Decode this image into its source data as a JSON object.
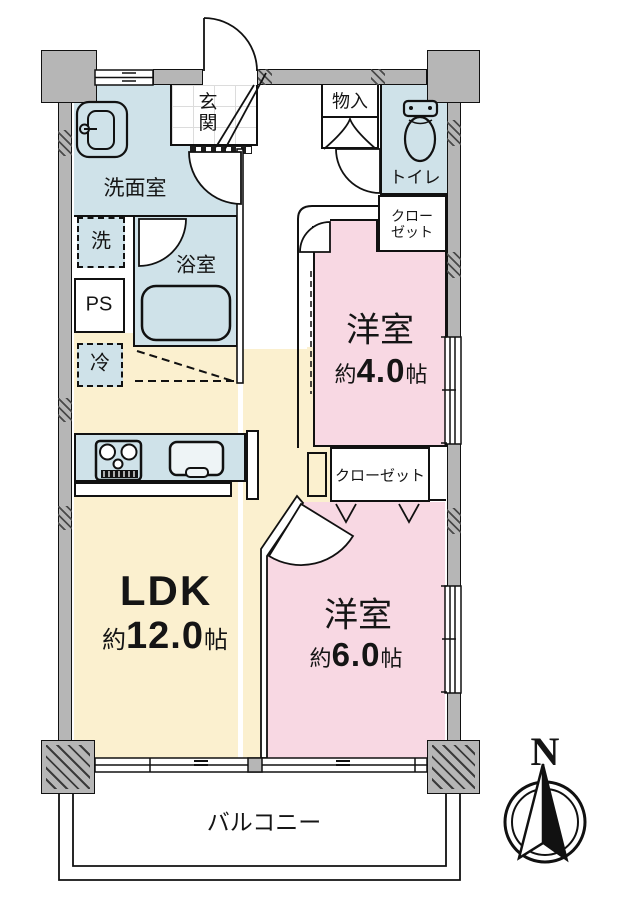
{
  "rooms": {
    "washroom": {
      "label": "洗面室"
    },
    "bath": {
      "label": "浴室"
    },
    "toilet": {
      "label": "トイレ"
    },
    "entrance": {
      "label": "玄関"
    },
    "storage": {
      "label": "物入"
    },
    "closet_upper": {
      "line1": "クロー",
      "line2": "ゼット"
    },
    "closet_lower": {
      "label": "クローゼット"
    },
    "bedroom_small": {
      "name": "洋室",
      "area_prefix": "約",
      "area_value": "4.0",
      "area_unit": "帖"
    },
    "bedroom_large": {
      "name": "洋室",
      "area_prefix": "約",
      "area_value": "6.0",
      "area_unit": "帖"
    },
    "ldk": {
      "name": "LDK",
      "area_prefix": "約",
      "area_value": "12.0",
      "area_unit": "帖"
    },
    "balcony": {
      "label": "バルコニー"
    },
    "pipe_space": {
      "label": "PS"
    },
    "washer": {
      "label": "洗"
    },
    "fridge": {
      "label": "冷"
    }
  },
  "compass": {
    "north_label": "N"
  },
  "colors": {
    "wet_area": "#cfe2e9",
    "bedroom": "#f8d8e3",
    "living": "#fbf0cf",
    "wall_gray": "#b6b6b6",
    "line": "#111111"
  }
}
